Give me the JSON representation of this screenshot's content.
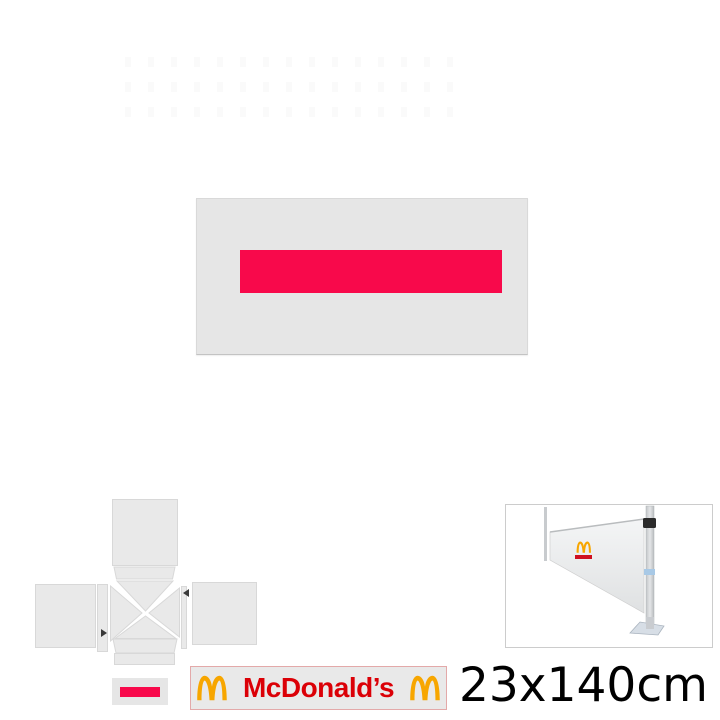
{
  "canvas": {
    "background": "#E6E6E6",
    "print_color": "#F8094B"
  },
  "diagram": {
    "panel_fill": "#E9E9E9",
    "panel_stroke": "#D8D8D8",
    "arrow_color": "#3A3A3A"
  },
  "photo": {
    "border_color": "#CCCCCC",
    "banner_fill": "#EDEFF0",
    "pole_fill": "#D3D6D9",
    "clamp_color": "#2B2B2B",
    "strap_color": "#A8C9E6",
    "base_color": "#D7DEE6"
  },
  "thumbnails": {
    "design_swatch": {
      "background": "#E6E6E6",
      "bar_color": "#F8094B"
    },
    "brand_panel": {
      "label": "McDonald’s",
      "label_color": "#DB0007",
      "arches_color": "#F7A600",
      "border_color": "#E3A9A9"
    }
  },
  "size_label": {
    "text": "23x140cm",
    "color": "#000000"
  }
}
